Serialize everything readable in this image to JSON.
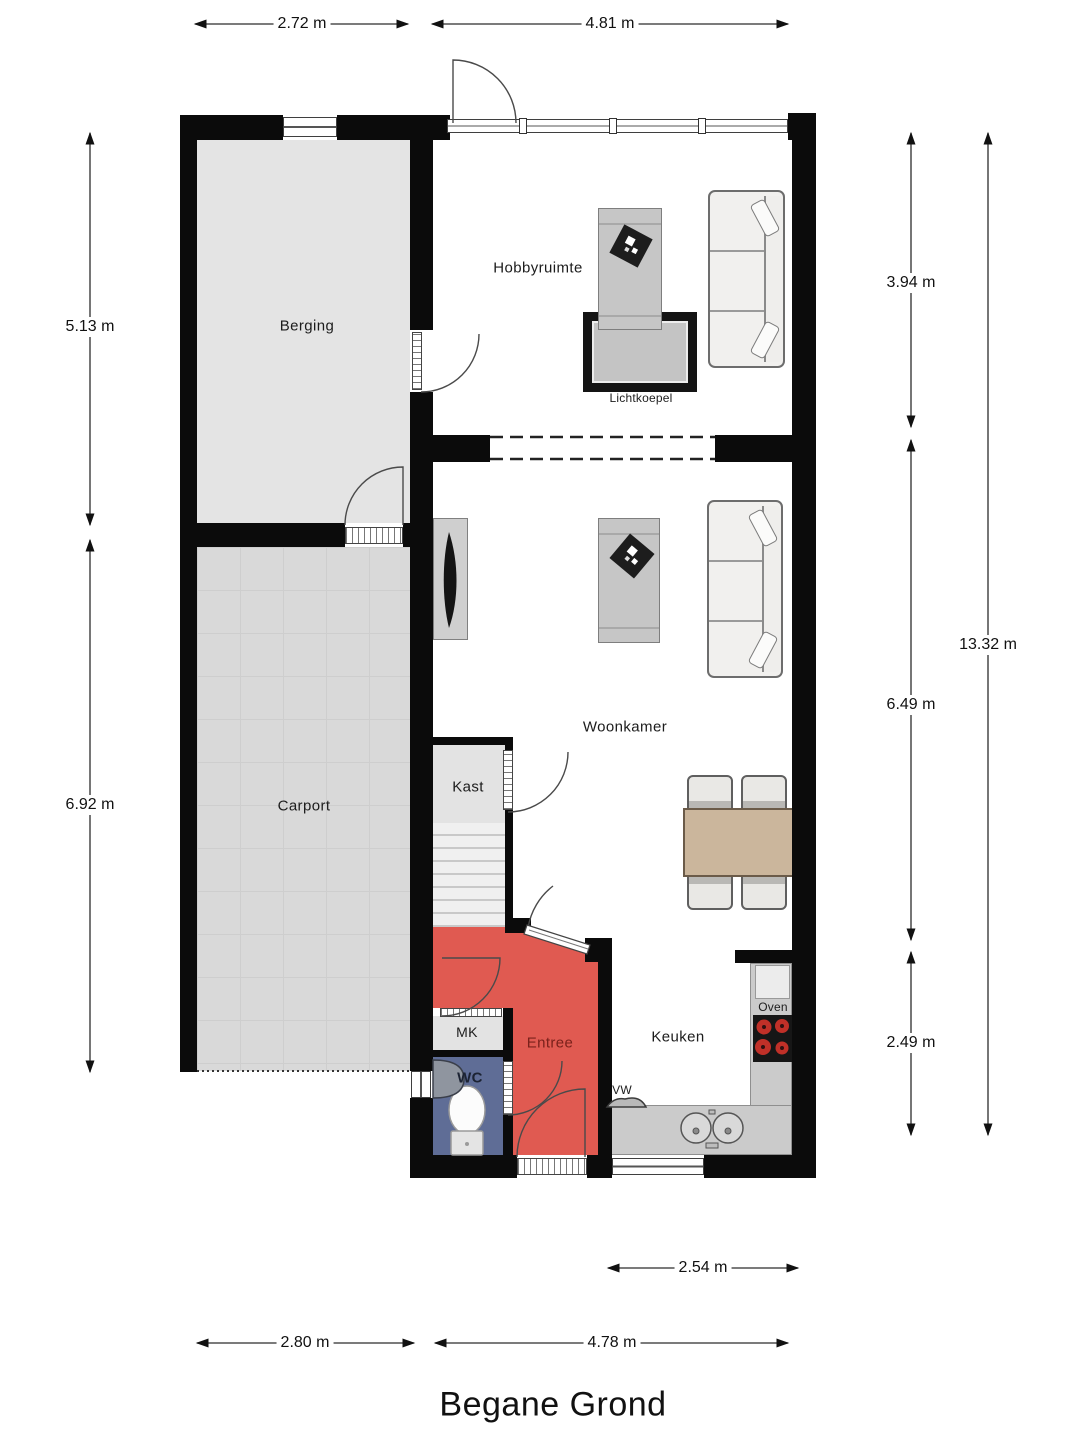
{
  "title": "Begane Grond",
  "rooms": {
    "berging": "Berging",
    "hobbyruimte": "Hobbyruimte",
    "lichtkoepel": "Lichtkoepel",
    "woonkamer": "Woonkamer",
    "carport": "Carport",
    "kast": "Kast",
    "entree": "Entree",
    "mk": "MK",
    "wc": "WC",
    "keuken": "Keuken",
    "oven": "Oven",
    "vw": "VW"
  },
  "dimensions": {
    "top_left": "2.72 m",
    "top_right": "4.81 m",
    "left_upper": "5.13 m",
    "left_lower": "6.92 m",
    "right_upper": "3.94 m",
    "right_middle": "6.49 m",
    "right_lower": "2.49 m",
    "right_total": "13.32 m",
    "bottom_kitchen": "2.54 m",
    "bottom_left": "2.80 m",
    "bottom_right": "4.78 m"
  },
  "colors": {
    "wall": "#0b0b0b",
    "entree_fill": "#e05a51",
    "entree_text": "#7a211b",
    "wc_fill": "#5f6d96",
    "wc_text": "#1c2333",
    "berging_fill": "#e4e4e4",
    "carport_fill": "#d9d9d9",
    "counter_fill": "#cbcbcb",
    "table_wood": "#cbb69c"
  }
}
